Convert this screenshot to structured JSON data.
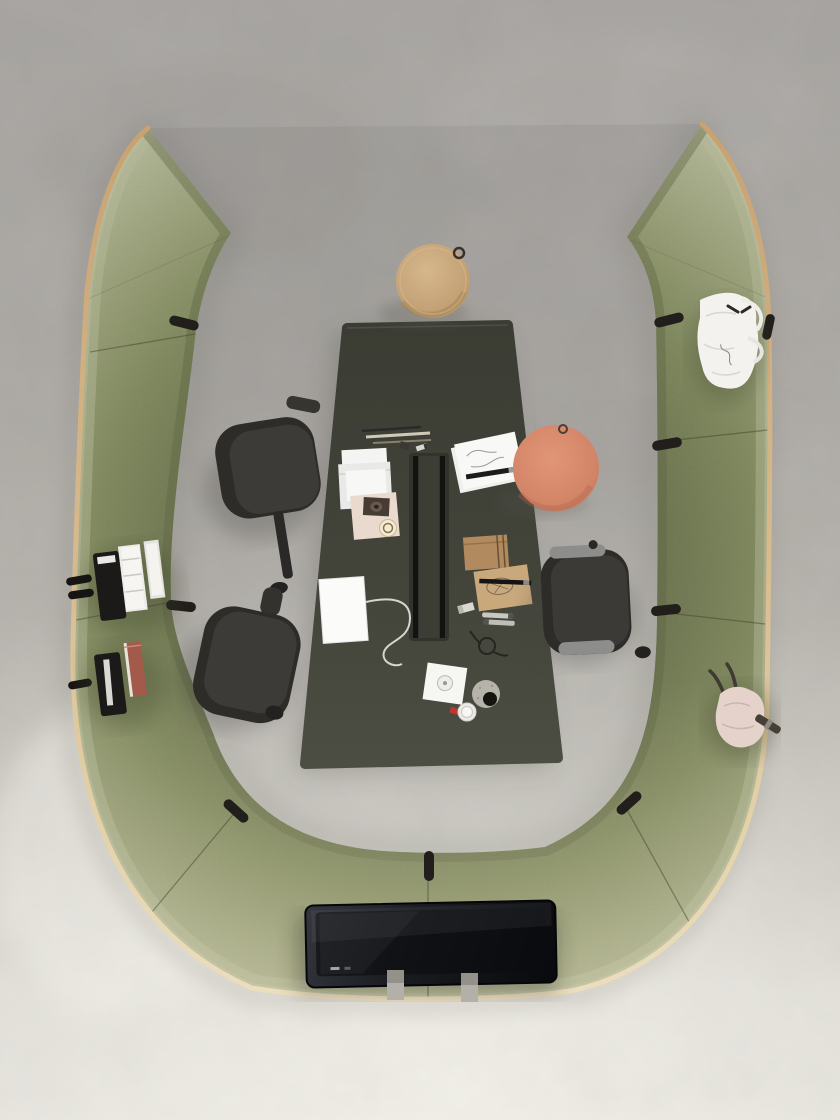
{
  "scene": {
    "kind": "top-down photograph",
    "subject": "modular acoustic meeting pod in an open office",
    "palette": {
      "floor_top_gray": "#a7a4a0",
      "floor_bottom_light": "#e4e2db",
      "panel_fabric_outer": "#aab08d",
      "panel_fabric_inner": "#6b7350",
      "panel_trim_wood": "#d2ab7b",
      "panel_trim_cream": "#ead9b4",
      "table_top": "#43453b",
      "cable_tray": "#2a2b26",
      "chair_upholstery": "#3a3835",
      "chair_armrest_metal": "#8d8d8b",
      "tv_screen": "#101217",
      "cork_stool": "#c9a87e",
      "pouf_salmon": "#d98a6f",
      "strap_black": "#211e1b",
      "book_red": "#a25a4b",
      "tote_bag_white": "#f3f2ee",
      "backpack_pink": "#e4d2cb",
      "paper_white": "#f7f7f4",
      "folder_tan": "#b28a5f",
      "kraft_envelope": "#c9a87c"
    },
    "objects": [
      {
        "name": "acoustic-pod-enclosure",
        "shape": "U-shaped sofa wall, wing tips at top",
        "sections": 7
      },
      {
        "name": "meeting-table",
        "shape": "trapezoid",
        "feature": "central cable tray"
      },
      {
        "name": "office-chair",
        "count": 3
      },
      {
        "name": "cork-stool",
        "position": "top center"
      },
      {
        "name": "round-pouf",
        "position": "right of table"
      },
      {
        "name": "flat-screen-tv",
        "position": "bottom panel"
      },
      {
        "name": "magazine-pockets",
        "position": "left panel",
        "contents": [
          "black pocket",
          "papers",
          "red book"
        ]
      },
      {
        "name": "white-tote-bag",
        "position": "right panel top"
      },
      {
        "name": "pink-backpack",
        "position": "right panel bottom"
      },
      {
        "name": "desk-items",
        "items": [
          "pencils",
          "envelopes",
          "washi tape card",
          "badge",
          "sketch papers",
          "marker pen",
          "tan folder",
          "kraft envelope",
          "eraser",
          "whiteboard markers",
          "earbuds loop",
          "white tablet with cable",
          "coaster pad",
          "speckled bowl",
          "small cup",
          "red cap"
        ]
      }
    ]
  }
}
